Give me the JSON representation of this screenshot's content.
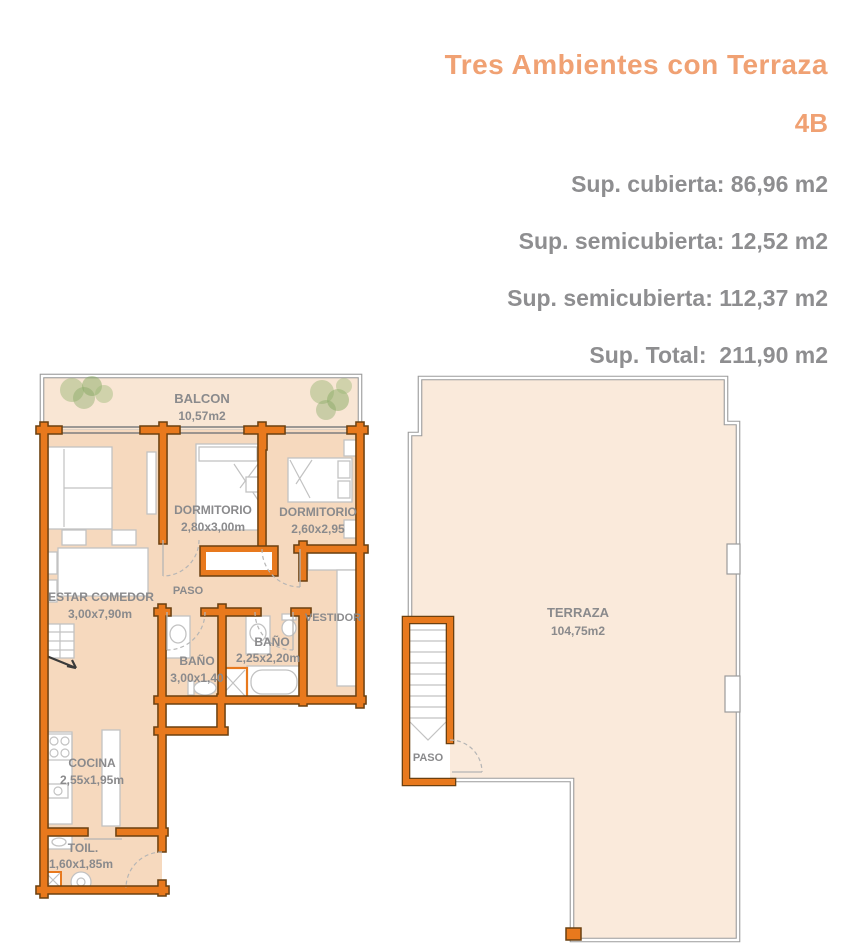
{
  "header": {
    "title": "Tres Ambientes con Terraza",
    "unit": "4B",
    "stats": [
      "Sup. cubierta: 86,96 m2",
      "Sup. semicubierta: 12,52 m2",
      "Sup. semicubierta: 112,37 m2",
      "Sup. Total:  211,90 m2"
    ]
  },
  "floorplans": {
    "left": {
      "balcon": {
        "name": "BALCON",
        "dims": "10,57m2"
      },
      "dormitorio_1": {
        "name": "DORMITORIO",
        "dims": "2,80x3,00m"
      },
      "dormitorio_2": {
        "name": "DORMITORIO",
        "dims": "2,60x2,95"
      },
      "estar_comedor": {
        "name": "ESTAR COMEDOR",
        "dims": "3,00x7,90m"
      },
      "paso": {
        "name": "PASO"
      },
      "bano_1": {
        "name": "BAÑO",
        "dims": "3,00x1,40"
      },
      "bano_2": {
        "name": "BAÑO",
        "dims": "2,25x2,20m"
      },
      "vestidor": {
        "name": "VESTIDOR"
      },
      "cocina": {
        "name": "COCINA",
        "dims": "2,55x1,95m"
      },
      "toilette": {
        "name": "TOIL.",
        "dims": "1,60x1,85m"
      }
    },
    "right": {
      "terraza": {
        "name": "TERRAZA",
        "dims": "104,75m2"
      },
      "paso": {
        "name": "PASO"
      }
    }
  },
  "colors": {
    "accent_orange": "#F0A173",
    "stats_gray": "#8E8E90",
    "wall_orange": "#E8791D",
    "wall_outline": "#6B4010",
    "room_fill": "#F6D9BE",
    "balcony_fill": "#F9E6D4",
    "terrace_fill": "#FAEADB",
    "label_gray": "#8A8A8C",
    "plant_green": "#8FB26B",
    "thin_wall_gray": "#9B9B9B"
  }
}
